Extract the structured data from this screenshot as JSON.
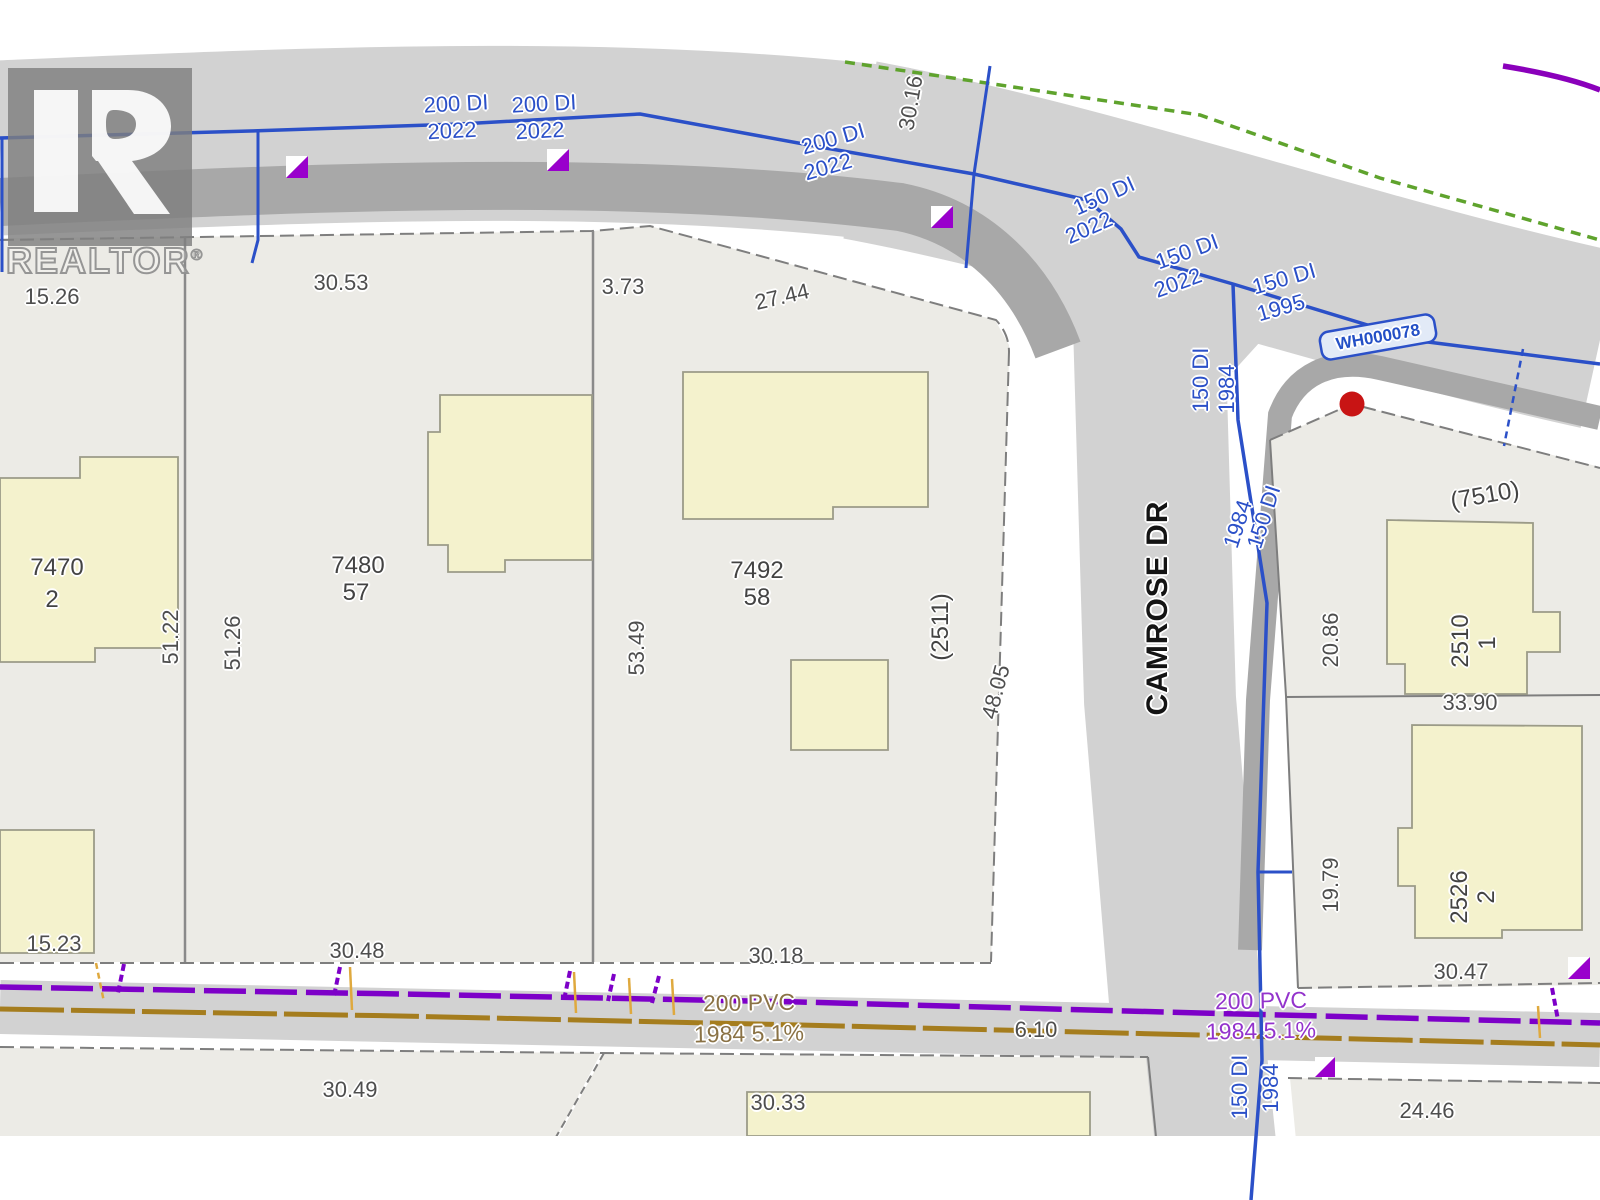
{
  "watermark": {
    "name": "REALTOR",
    "reg": "®"
  },
  "street": {
    "name": "CAMROSE DR"
  },
  "colors": {
    "road": "#d2d2d2",
    "curb": "#a8a8a8",
    "parcel_fill": "#ecebe6",
    "building_fill": "#f4f2cd",
    "water_line": "#2b50c8",
    "sewer_line": "#7d00c8",
    "second_main_line": "#a57d1e",
    "service_tick_orange": "#dfa93e",
    "boundary_green": "#5fa32d",
    "corner_purple": "#8a00bb",
    "marker_red": "#c81414"
  },
  "utilities": {
    "hydrant_id": "WH000078"
  },
  "labels": [
    {
      "id": "dim-15-26",
      "text": "15.26",
      "x": 52,
      "y": 297,
      "rot": 0,
      "cls": "dim"
    },
    {
      "id": "dim-30-53",
      "text": "30.53",
      "x": 341,
      "y": 283,
      "rot": 0,
      "cls": "dim"
    },
    {
      "id": "dim-3-73",
      "text": "3.73",
      "x": 623,
      "y": 287,
      "rot": 0,
      "cls": "dim"
    },
    {
      "id": "dim-27-44",
      "text": "27.44",
      "x": 782,
      "y": 297,
      "rot": -13,
      "cls": "dim"
    },
    {
      "id": "dim-30-16",
      "text": "30.16",
      "x": 911,
      "y": 103,
      "rot": -80,
      "cls": "dim"
    },
    {
      "id": "dim-51-22",
      "text": "51.22",
      "x": 171,
      "y": 637,
      "rot": -90,
      "cls": "dim"
    },
    {
      "id": "dim-51-26",
      "text": "51.26",
      "x": 233,
      "y": 643,
      "rot": -90,
      "cls": "dim"
    },
    {
      "id": "dim-53-49",
      "text": "53.49",
      "x": 637,
      "y": 648,
      "rot": -90,
      "cls": "dim"
    },
    {
      "id": "dim-48-05",
      "text": "48.05",
      "x": 996,
      "y": 692,
      "rot": -75,
      "cls": "dim"
    },
    {
      "id": "dim-20-86",
      "text": "20.86",
      "x": 1331,
      "y": 640,
      "rot": -90,
      "cls": "dim"
    },
    {
      "id": "dim-33-90",
      "text": "33.90",
      "x": 1470,
      "y": 703,
      "rot": 0,
      "cls": "dim"
    },
    {
      "id": "dim-19-79",
      "text": "19.79",
      "x": 1331,
      "y": 885,
      "rot": -90,
      "cls": "dim"
    },
    {
      "id": "dim-30-47",
      "text": "30.47",
      "x": 1461,
      "y": 972,
      "rot": 0,
      "cls": "dim"
    },
    {
      "id": "dim-30-48",
      "text": "30.48",
      "x": 357,
      "y": 951,
      "rot": 0,
      "cls": "dim"
    },
    {
      "id": "dim-15-23",
      "text": "15.23",
      "x": 54,
      "y": 944,
      "rot": 0,
      "cls": "dim"
    },
    {
      "id": "dim-30-18",
      "text": "30.18",
      "x": 776,
      "y": 956,
      "rot": 0,
      "cls": "dim"
    },
    {
      "id": "dim-6-10",
      "text": "6.10",
      "x": 1036,
      "y": 1030,
      "rot": 0,
      "cls": "dim"
    },
    {
      "id": "dim-30-49",
      "text": "30.49",
      "x": 350,
      "y": 1090,
      "rot": 0,
      "cls": "dim"
    },
    {
      "id": "dim-30-33",
      "text": "30.33",
      "x": 778,
      "y": 1103,
      "rot": 0,
      "cls": "dim"
    },
    {
      "id": "dim-24-46",
      "text": "24.46",
      "x": 1427,
      "y": 1111,
      "rot": 0,
      "cls": "dim"
    },
    {
      "id": "parcel-7470",
      "text": "7470",
      "x": 57,
      "y": 568,
      "rot": 0,
      "cls": "parcel"
    },
    {
      "id": "parcel-7470-lot",
      "text": "2",
      "x": 52,
      "y": 600,
      "rot": 0,
      "cls": "parcel"
    },
    {
      "id": "parcel-7480",
      "text": "7480",
      "x": 358,
      "y": 566,
      "rot": 0,
      "cls": "parcel"
    },
    {
      "id": "parcel-7480-lot",
      "text": "57",
      "x": 356,
      "y": 593,
      "rot": 0,
      "cls": "parcel"
    },
    {
      "id": "parcel-7492",
      "text": "7492",
      "x": 757,
      "y": 571,
      "rot": 0,
      "cls": "parcel"
    },
    {
      "id": "parcel-7492-lot",
      "text": "58",
      "x": 757,
      "y": 598,
      "rot": 0,
      "cls": "parcel"
    },
    {
      "id": "parcel-2511",
      "text": "(2511)",
      "x": 941,
      "y": 627,
      "rot": -90,
      "cls": "parcel"
    },
    {
      "id": "parcel-7510",
      "text": "(7510)",
      "x": 1485,
      "y": 496,
      "rot": -10,
      "cls": "parcel"
    },
    {
      "id": "parcel-2510",
      "text": "2510",
      "x": 1461,
      "y": 641,
      "rot": -90,
      "cls": "parcel"
    },
    {
      "id": "parcel-2510-lot",
      "text": "1",
      "x": 1488,
      "y": 643,
      "rot": -90,
      "cls": "parcel"
    },
    {
      "id": "parcel-2526",
      "text": "2526",
      "x": 1460,
      "y": 897,
      "rot": -90,
      "cls": "parcel"
    },
    {
      "id": "parcel-2526-lot",
      "text": "2",
      "x": 1487,
      "y": 897,
      "rot": -90,
      "cls": "parcel"
    },
    {
      "id": "water-200di-1",
      "text": "200 DI",
      "x": 456,
      "y": 104,
      "rot": -3,
      "cls": "water"
    },
    {
      "id": "water-2022-1",
      "text": "2022",
      "x": 452,
      "y": 131,
      "rot": -3,
      "cls": "water"
    },
    {
      "id": "water-200di-2",
      "text": "200 DI",
      "x": 544,
      "y": 104,
      "rot": -3,
      "cls": "water"
    },
    {
      "id": "water-2022-2",
      "text": "2022",
      "x": 540,
      "y": 131,
      "rot": -3,
      "cls": "water"
    },
    {
      "id": "water-200di-3",
      "text": "200 DI",
      "x": 833,
      "y": 139,
      "rot": -16,
      "cls": "water"
    },
    {
      "id": "water-2022-3",
      "text": "2022",
      "x": 828,
      "y": 167,
      "rot": -16,
      "cls": "water"
    },
    {
      "id": "water-150di-1",
      "text": "150 DI",
      "x": 1104,
      "y": 196,
      "rot": -24,
      "cls": "water"
    },
    {
      "id": "water-2022-4",
      "text": "2022",
      "x": 1089,
      "y": 228,
      "rot": -24,
      "cls": "water"
    },
    {
      "id": "water-150di-2",
      "text": "150 DI",
      "x": 1187,
      "y": 252,
      "rot": -20,
      "cls": "water"
    },
    {
      "id": "water-2022-5",
      "text": "2022",
      "x": 1178,
      "y": 283,
      "rot": -20,
      "cls": "water"
    },
    {
      "id": "water-150di-3",
      "text": "150 DI",
      "x": 1284,
      "y": 279,
      "rot": -16,
      "cls": "water"
    },
    {
      "id": "water-1995",
      "text": "1995",
      "x": 1281,
      "y": 308,
      "rot": -16,
      "cls": "water"
    },
    {
      "id": "water-wh000078",
      "text": "WH000078",
      "x": 1378,
      "y": 337,
      "rot": -10,
      "cls": "water-box"
    },
    {
      "id": "water-150di-v1",
      "text": "150 DI",
      "x": 1201,
      "y": 380,
      "rot": -90,
      "cls": "water"
    },
    {
      "id": "water-1984-v1",
      "text": "1984",
      "x": 1227,
      "y": 389,
      "rot": -90,
      "cls": "water"
    },
    {
      "id": "water-150di-v2",
      "text": "150 DI",
      "x": 1264,
      "y": 517,
      "rot": -72,
      "cls": "water"
    },
    {
      "id": "water-1984-v2",
      "text": "1238",
      "x": -999,
      "y": -999,
      "rot": 0,
      "cls": "water"
    },
    {
      "id": "water-150di-v3",
      "text": "150 DI",
      "x": 1240,
      "y": 1087,
      "rot": -90,
      "cls": "water"
    },
    {
      "id": "water-1984-v3",
      "text": "1984",
      "x": 1271,
      "y": 1088,
      "rot": -90,
      "cls": "water"
    },
    {
      "id": "sewer-200pvc-west",
      "text": "200 PVC",
      "x": 749,
      "y": 1003,
      "rot": -1,
      "cls": "pvc-brown"
    },
    {
      "id": "sewer-1984-west",
      "text": "1984 5.1%",
      "x": 749,
      "y": 1034,
      "rot": -1,
      "cls": "pvc-brown"
    },
    {
      "id": "sewer-200pvc-east",
      "text": "200 PVC",
      "x": 1261,
      "y": 1001,
      "rot": -1,
      "cls": "pvc-purple"
    },
    {
      "id": "sewer-1984-east",
      "text": "1984 5.1%",
      "x": 1261,
      "y": 1031,
      "rot": -1,
      "cls": "pvc-purple"
    },
    {
      "id": "street-camrose-dr",
      "text": "CAMROSE DR",
      "x": 1158,
      "y": 608,
      "rot": -90,
      "cls": "street"
    }
  ],
  "labels_fix": [
    {
      "id": "water-1984-v2",
      "text": "1984",
      "x": 1238,
      "y": 524,
      "rot": -72,
      "cls": "water"
    }
  ]
}
